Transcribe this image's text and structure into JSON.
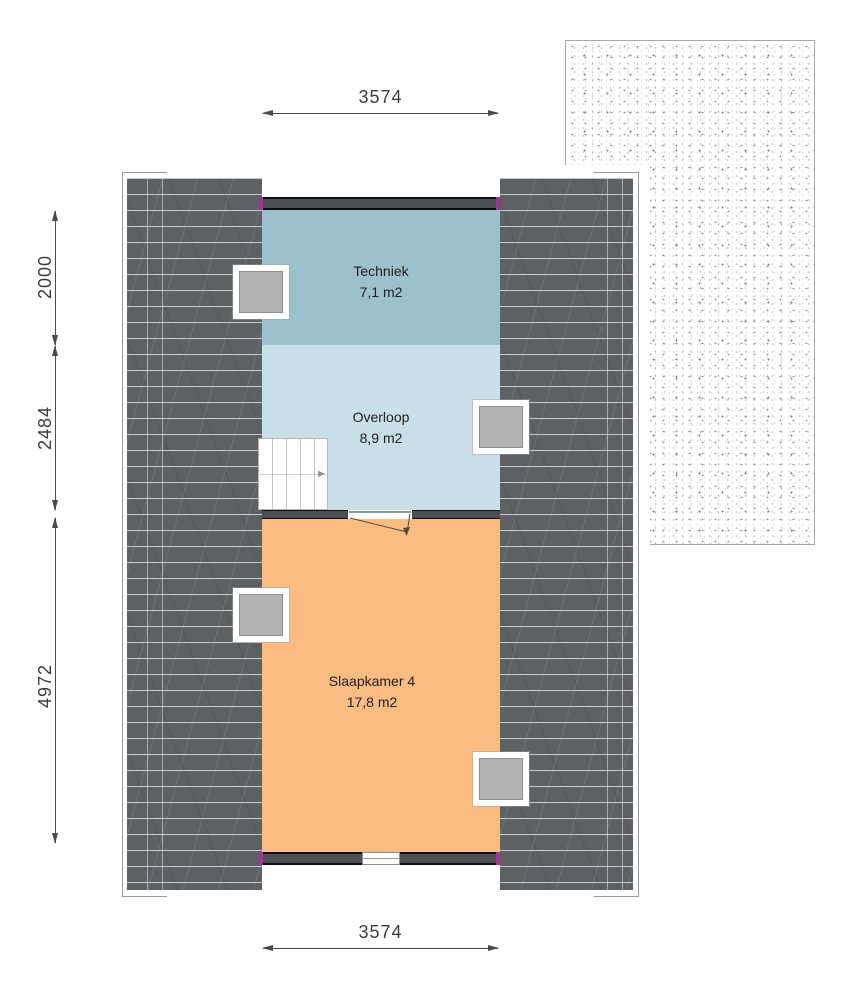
{
  "rooms": [
    {
      "name": "Techniek",
      "area": "7,1 m2"
    },
    {
      "name": "Overloop",
      "area": "8,9 m2"
    },
    {
      "name": "Slaapkamer 4",
      "area": "17,8 m2"
    }
  ],
  "dimensions": {
    "top": "3574",
    "bottom": "3574",
    "left": [
      {
        "value": "2000"
      },
      {
        "value": "2484"
      },
      {
        "value": "4972"
      }
    ]
  },
  "stairs": {
    "direction_arrow": "►"
  },
  "colors": {
    "roof": "#5e6164",
    "wall": "#4c4f54",
    "junction_marker": "#a23399",
    "room_techniek": "#9cc1cd",
    "room_overloop": "#c9dfe9",
    "room_slaapkamer": "#fabc80",
    "roof_window_glass": "#b3b3b3",
    "dimension": "#444444"
  }
}
